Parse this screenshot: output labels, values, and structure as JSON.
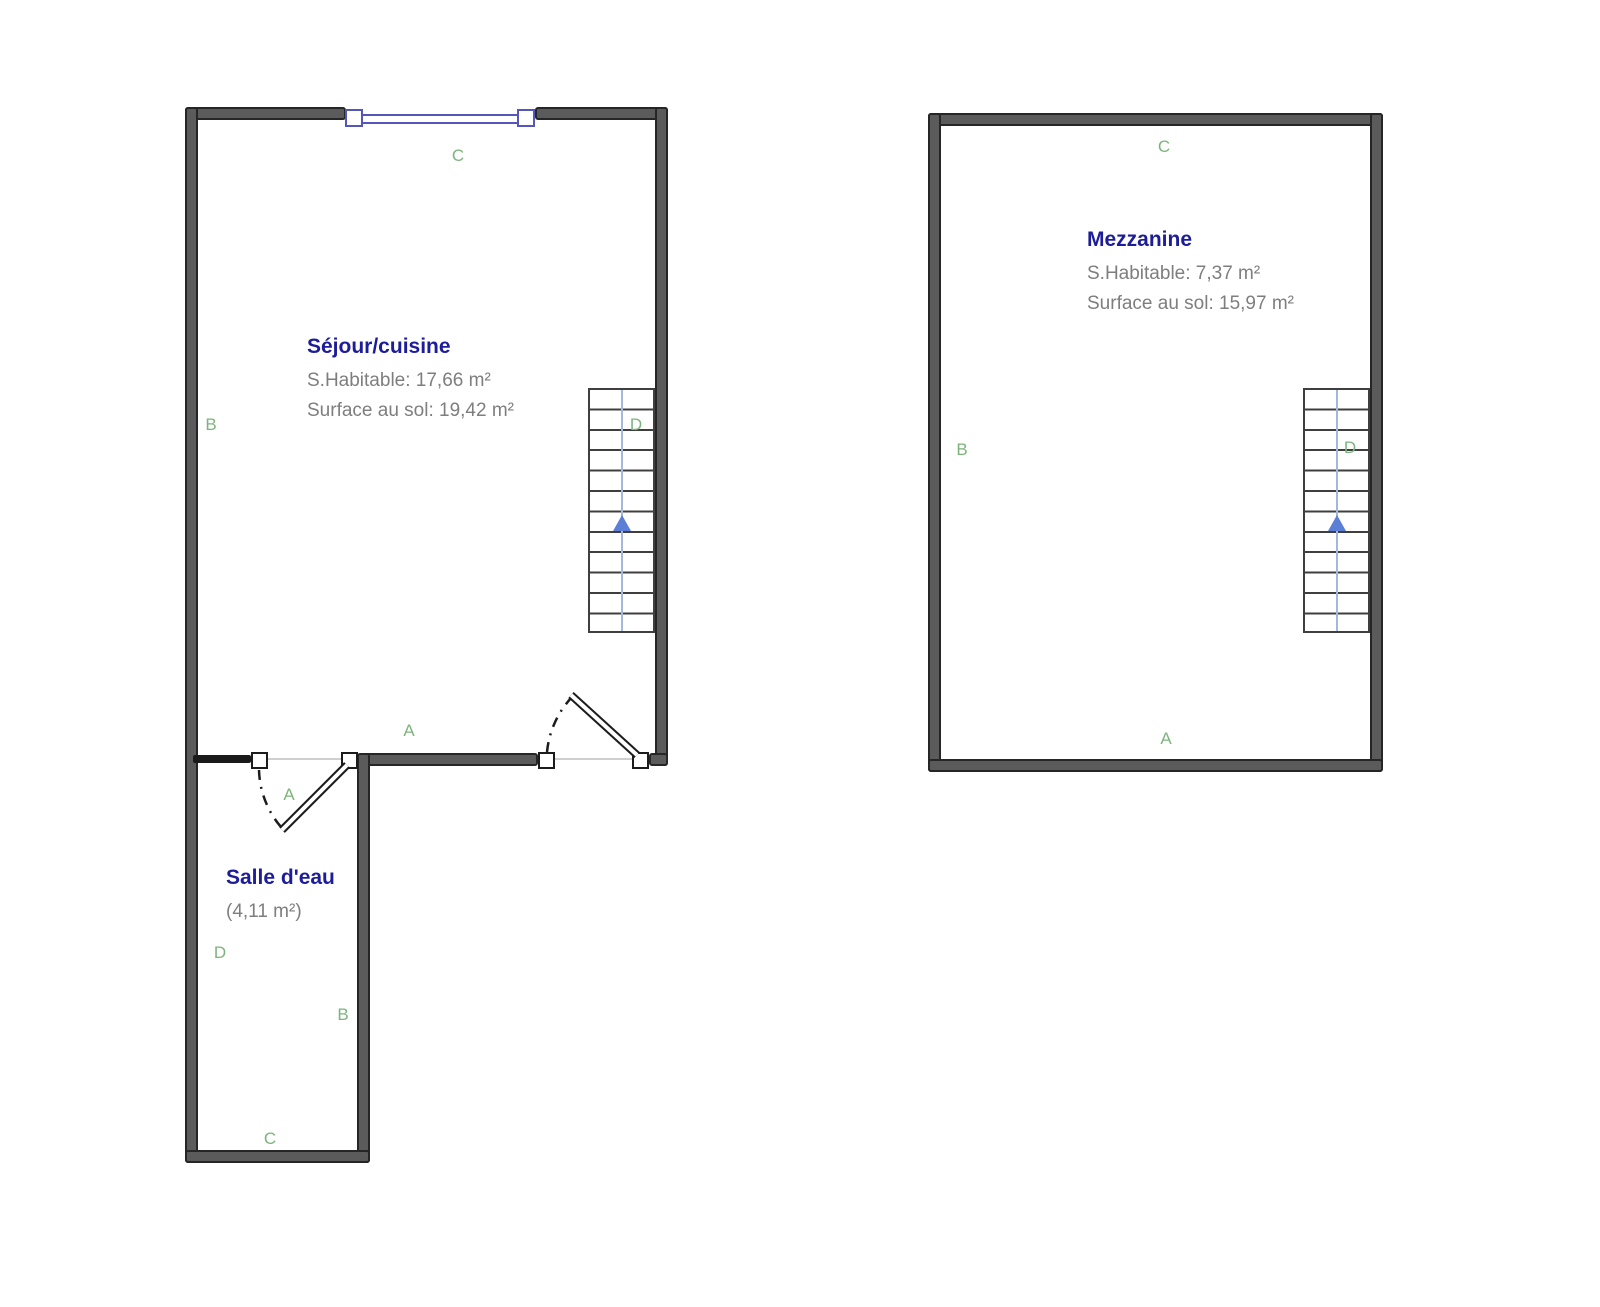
{
  "document": {
    "background": "#ffffff",
    "type_hint": "floor-plan"
  },
  "colors": {
    "wall_fill": "#5b5b5b",
    "wall_outline": "#262626",
    "window_blue": "#5456bd",
    "stair_arrow_blue": "#5b7fd6",
    "stair_guide_blue": "#a3b8dc",
    "room_title_navy": "#1d1d99",
    "room_area_gray": "#7e7e7e",
    "wall_label_green": "#7cb57c"
  },
  "plans": [
    {
      "name": "ground-floor",
      "rooms": [
        {
          "title": "Séjour/cuisine",
          "area_line1": "S.Habitable: 17,66 m²",
          "area_line2": "Surface au sol: 19,42 m²"
        },
        {
          "title": "Salle d'eau",
          "area_line1": "(4,11 m²)"
        }
      ],
      "wall_labels": {
        "top": "C",
        "left": "B",
        "stairs": "D",
        "bottom": "A",
        "door": "A",
        "sde_left": "D",
        "sde_right": "B",
        "sde_bottom": "C"
      }
    },
    {
      "name": "mezzanine",
      "rooms": [
        {
          "title": "Mezzanine",
          "area_line1": "S.Habitable: 7,37 m²",
          "area_line2": "Surface au sol: 15,97 m²"
        }
      ],
      "wall_labels": {
        "top": "C",
        "left": "B",
        "stairs": "D",
        "bottom": "A"
      }
    }
  ]
}
